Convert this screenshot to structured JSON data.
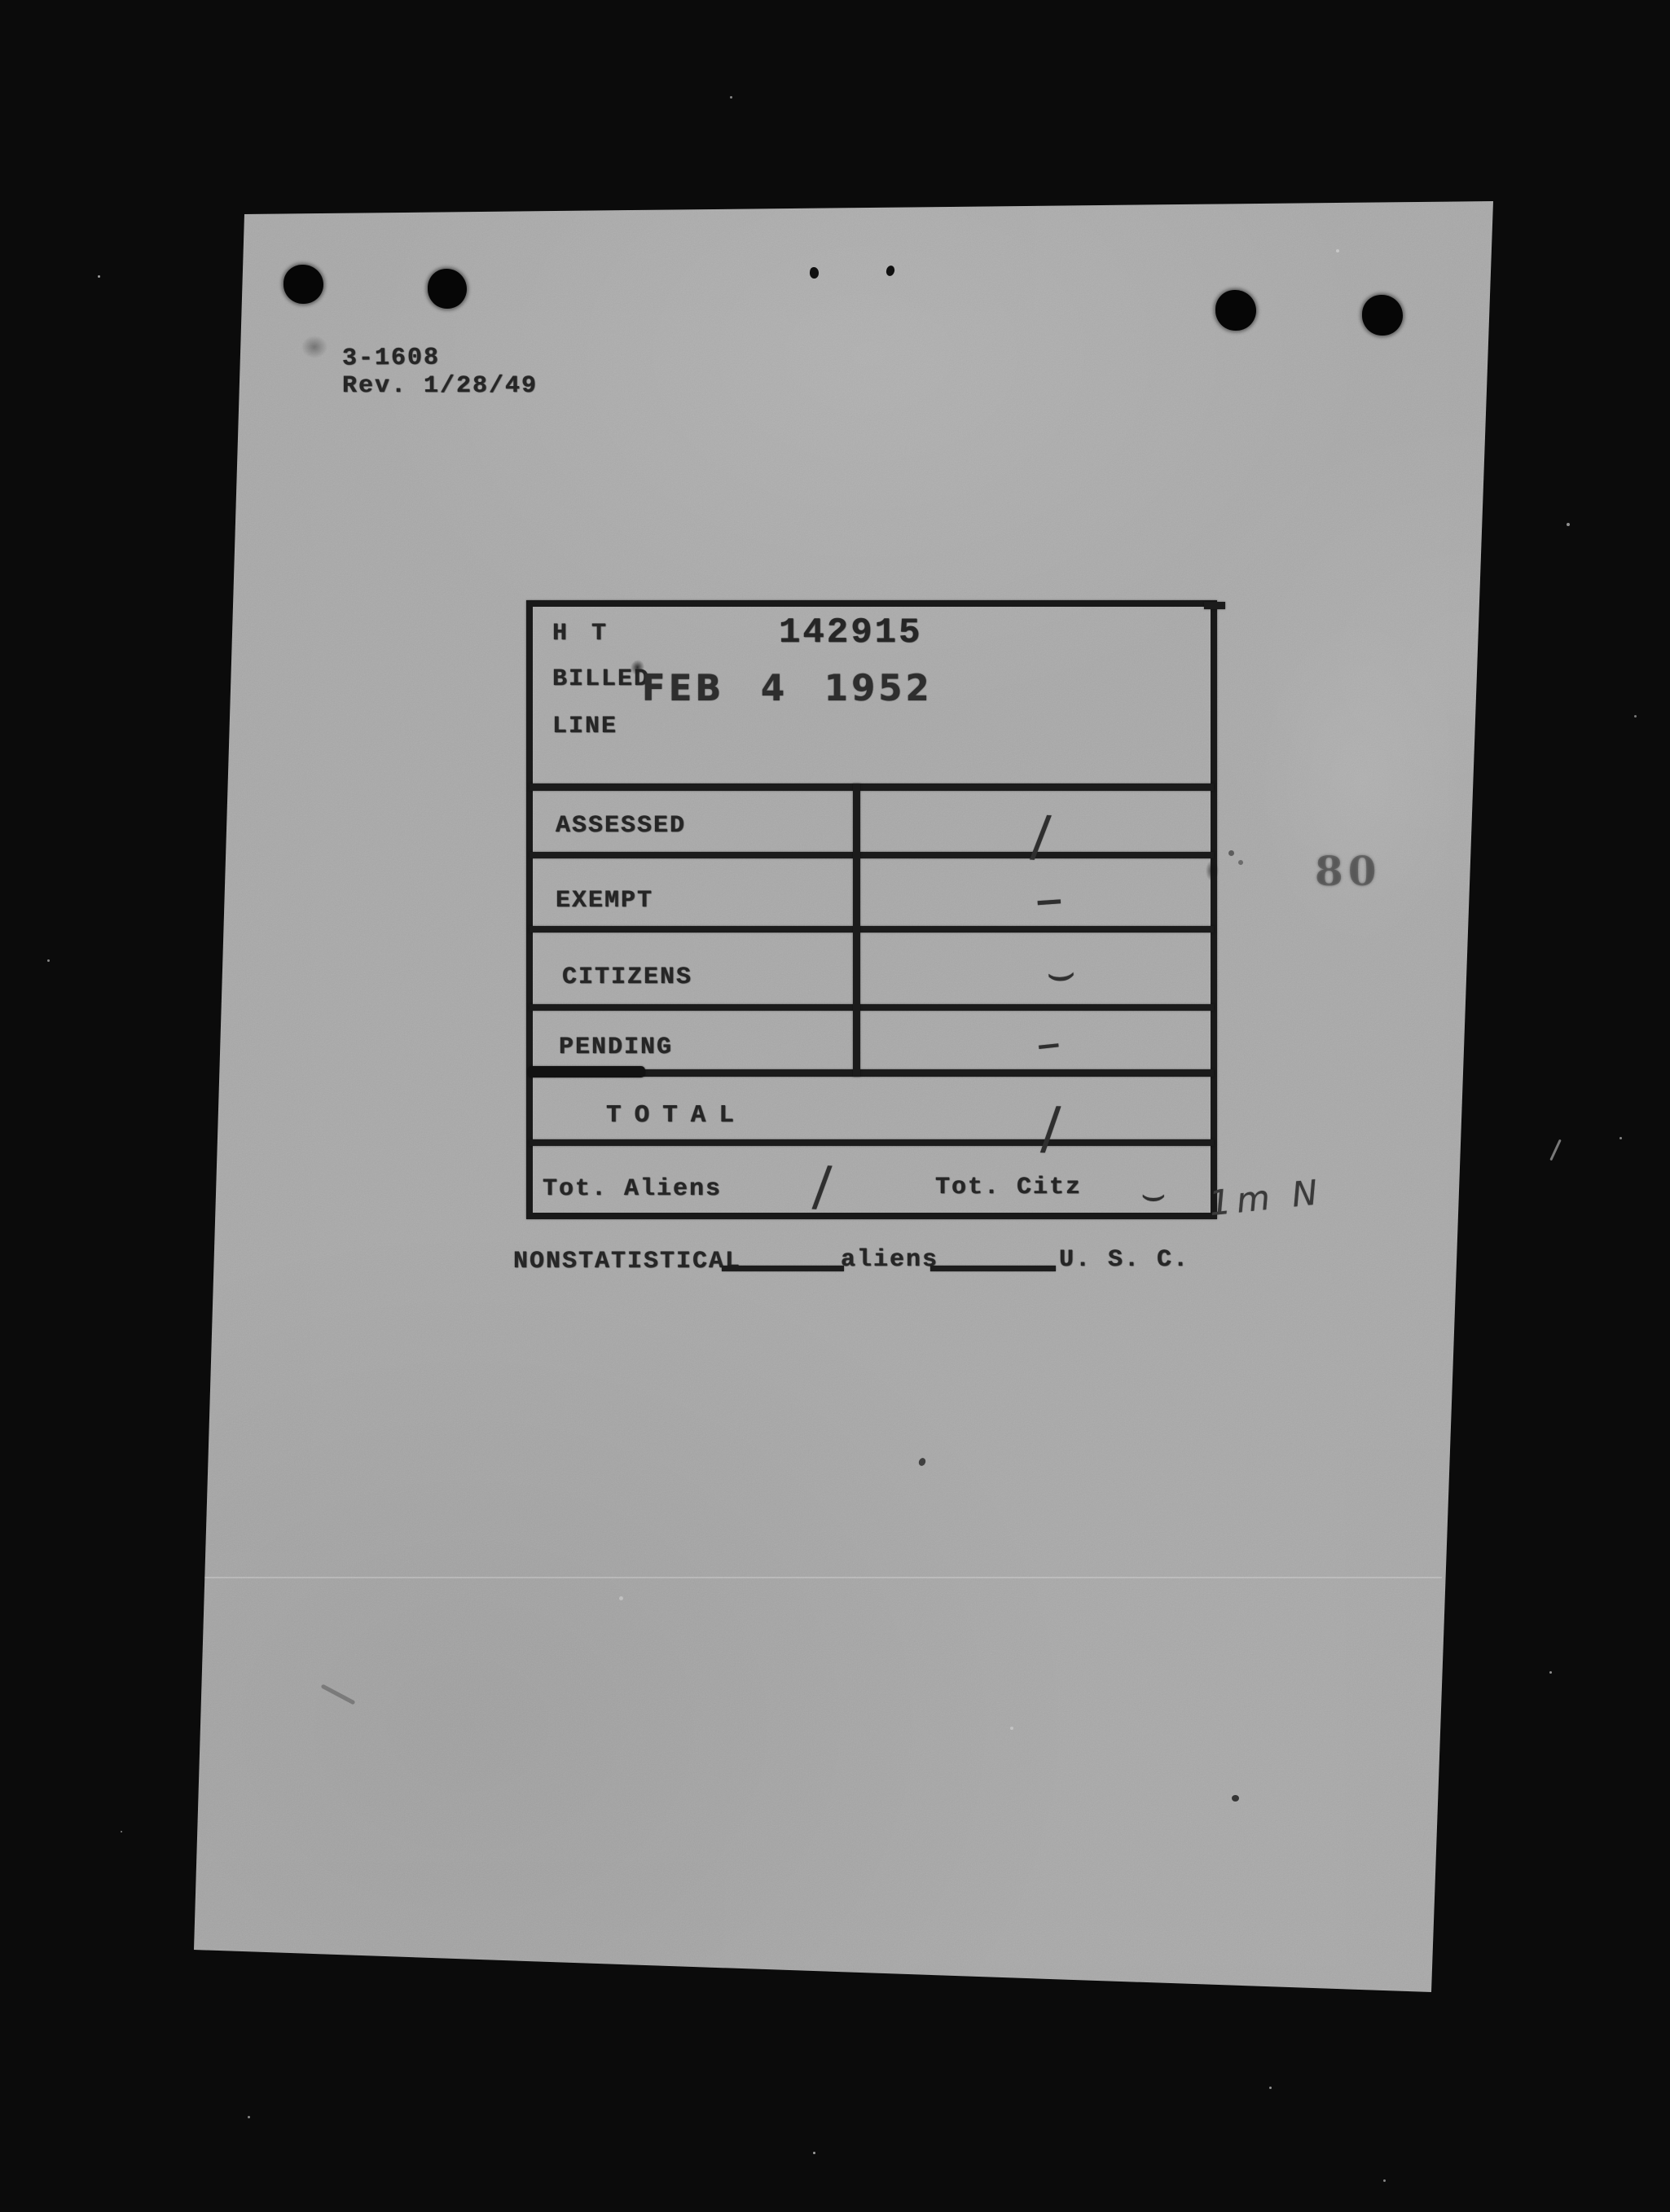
{
  "scan": {
    "form_number": "3-1608",
    "revision": "Rev. 1/28/49",
    "page_stamp": "80"
  },
  "table": {
    "ht_label": "H T",
    "ht_number": "142915",
    "billed_label": "BILLED",
    "date_stamp": "FEB 4 1952",
    "line_label": "LINE",
    "rows": [
      {
        "label": "ASSESSED",
        "mark": "/"
      },
      {
        "label": "EXEMPT",
        "mark": "–"
      },
      {
        "label": "CITIZENS",
        "mark": "⌣"
      },
      {
        "label": "PENDING",
        "mark": "–"
      }
    ],
    "total_label": "TOTAL",
    "total_mark": "/",
    "tot_aliens_label": "Tot. Aliens",
    "tot_aliens_mark": "/",
    "tot_citz_label": "Tot. Citz",
    "tot_citz_mark": "⌣"
  },
  "footer_line": {
    "nonstatistical_label": "NONSTATISTICAL",
    "aliens_label": "aliens",
    "usc_label": "U. S. C."
  },
  "annotations": {
    "margin_note": "1m N"
  }
}
